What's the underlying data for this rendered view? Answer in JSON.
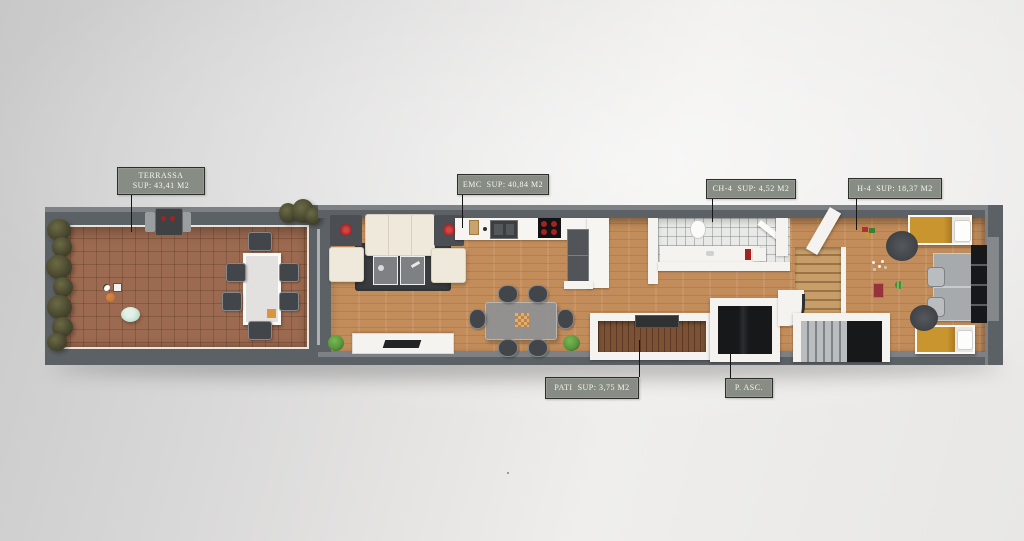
{
  "labels": {
    "terrassa": {
      "line1": "TERRASSA",
      "line2": "SUP: 43,41 M2"
    },
    "emc": {
      "text": "EMC  SUP: 40,84 M2"
    },
    "ch4": {
      "text": "CH-4  SUP: 4,52 M2"
    },
    "h4": {
      "text": "H-4  SUP: 18,37 M2"
    },
    "pati": {
      "text": "PATI  SUP: 3,75 M2"
    },
    "pasc": {
      "text": "P. ASC."
    }
  },
  "colors": {
    "wall_outer": "#5c6165",
    "wall_light_face": "#7d8185",
    "interior_white": "#f4f3f0",
    "terrace_tile": "#9c6a50",
    "wood_floor": "#c38d5b",
    "patio_deck": "#7c5134",
    "bath_tile": "#e9eae8",
    "rug_dark": "#3a3c3e",
    "sofa_cream": "#efe9dc",
    "bed_yellow": "#c9952f",
    "elevator_dark": "#17181a",
    "label_bg": "#878c84",
    "label_border": "#2e2e2c",
    "label_text": "#f4f4ef",
    "chair_dark": "#42454a",
    "plant_olive": "#4a4930",
    "plant_green": "#57963f",
    "accent_red": "#a32222",
    "pool_aqua": "#bcdfce",
    "ball_orange": "#c06a2e",
    "table_gray": "#8f9294",
    "counter_white": "#f6f5f2",
    "appliance_gray": "#515458",
    "stair_wood": "#c79e69"
  }
}
